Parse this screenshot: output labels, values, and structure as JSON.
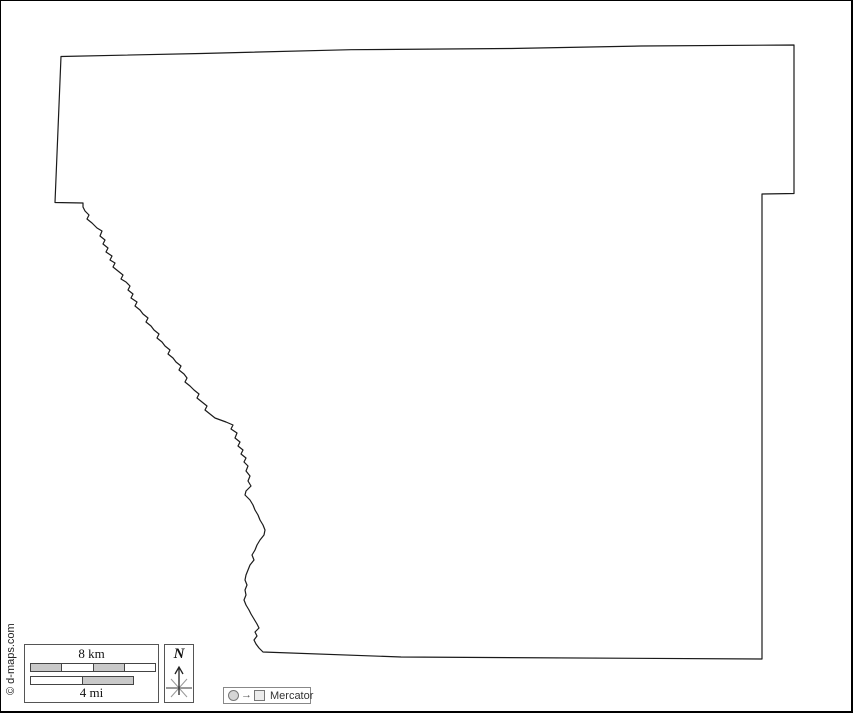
{
  "map": {
    "outline_path": "M 60 55.5 L 54 201.5 L 82 202 L 82 206 L 84 210 L 88 214 L 86 218 L 91 222 L 96 227 L 101 230 L 99 235 L 104 239 L 102 243 L 107 247 L 105 251 L 111 255 L 109 259 L 114 262 L 112 266 L 117 270 L 122 274 L 120 278 L 125 281 L 129 285 L 127 289 L 132 293 L 130 297 L 136 301 L 134 305 L 139 309 L 142 313 L 147 317 L 145 321 L 150 325 L 153 329 L 158 333 L 156 337 L 161 341 L 164 345 L 169 349 L 167 353 L 172 357 L 175 361 L 180 365 L 178 369 L 183 373 L 186 377 L 184 381 L 189 385 L 193 389 L 198 393 L 196 397 L 201 401 L 206 405 L 204 409 L 209 413 L 214 417 L 225 421 L 232 424 L 230 428 L 236 432 L 234 437 L 239 441 L 237 445 L 242 449 L 240 453 L 245 457 L 243 461 L 247 465 L 245 470 L 249 475 L 247 480 L 250 485 L 245 490 L 244 494 L 249 499 L 252 504 L 254 509 L 257 514 L 259 519 L 262 524 L 264 529 L 263 534 L 259 539 L 256 544 L 254 549 L 251 554 L 253 559 L 249 564 L 247 569 L 245 574 L 244 579 L 246 584 L 244 589 L 245 594 L 243 599 L 245 604 L 248 609 L 250 613 L 253 618 L 256 623 L 258 627 L 254 631 L 256 635 L 253 639 L 255 643 L 258 647 L 262 651 L 400 656 L 761 658 L 761 193 L 793 192.5 L 793 44 L 640 45 L 510 47.5 L 350 48.7 L 200 52.5 Z"
  },
  "scale_bar": {
    "km_label": "8 km",
    "mi_label": "4 mi"
  },
  "north_indicator": {
    "label": "N"
  },
  "projection_legend": {
    "label": "Mercator",
    "arrow_glyph": "→"
  },
  "copyright": {
    "text": "© d-maps.com"
  },
  "colors": {
    "outline": "#1a1a1a",
    "frame": "#000000",
    "bar_gray": "#c9c9c9",
    "bar_white": "#ffffff",
    "box_border": "#555555",
    "legend_border": "#888888",
    "legend_text": "#333333"
  }
}
